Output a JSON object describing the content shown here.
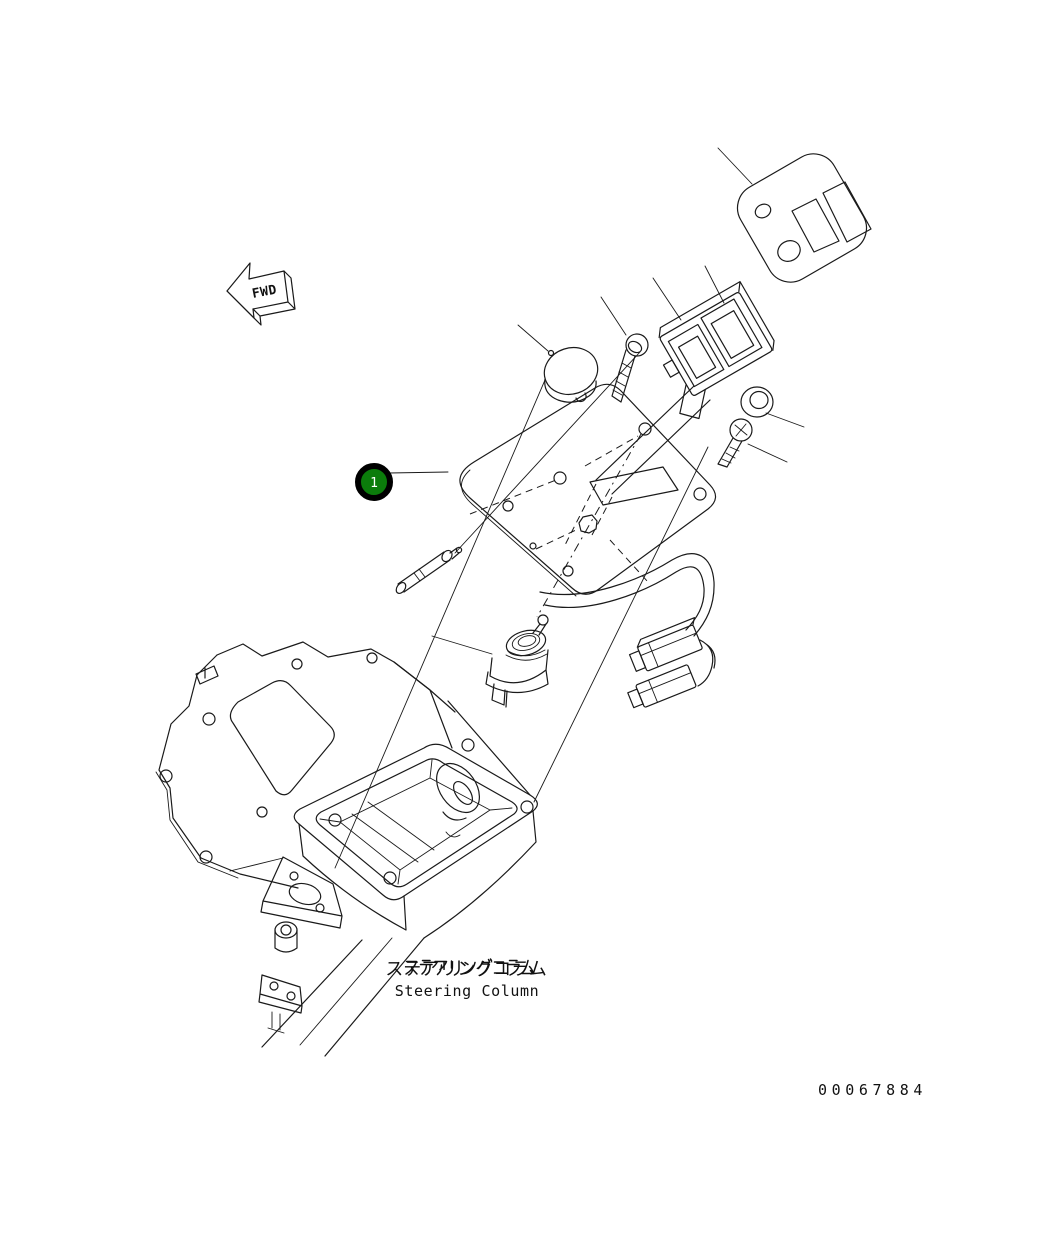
{
  "page": {
    "background": "#ffffff"
  },
  "diagram": {
    "type": "exploded-parts-diagram",
    "fwd_label": "FWD",
    "balloon": {
      "number": "1",
      "fill": "#0b7c0b",
      "ring_color": "#000000",
      "text_color": "#ffffff"
    },
    "caption": {
      "japanese": "ステアリングコラム",
      "english": "Steering Column"
    },
    "drawing_number": "00067884",
    "line_color": "#1a1a1a",
    "parts": [
      {
        "balloon": "1",
        "name_en": "Steering Column panel assembly"
      }
    ]
  }
}
